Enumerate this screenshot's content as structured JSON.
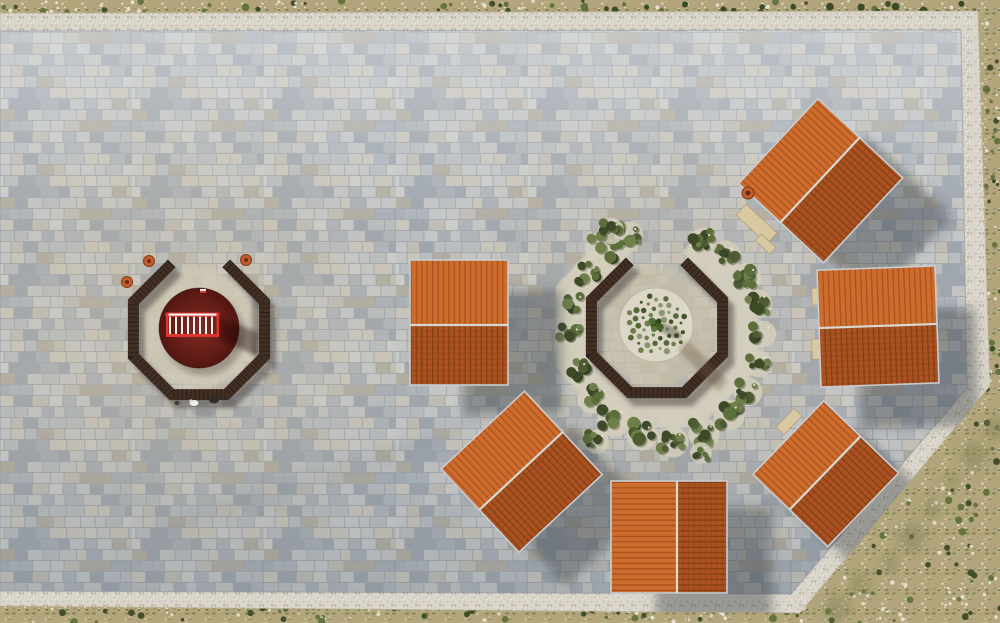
{
  "scene": {
    "width": 1000,
    "height": 623,
    "description": "aerial-drone-view-of-stone-paved-plaza-with-orange-roof-pavilions-and-two-octagonal-seating-gardens"
  },
  "palette": {
    "scrub_base": "#b2a57b",
    "scrub_dark": "#8c835c",
    "shrub_green": "#5c6e3a",
    "shrub_dark": "#3d4a27",
    "rock_white": "#eae6d9",
    "moss": "#85855a",
    "rubble_base": "#d9d5ca",
    "rubble_dot_dark": "#aaa294",
    "rubble_dot_light": "#f3f0e7",
    "rubble_dot_brown": "#b9a88e",
    "paving_gap": "#a2a8ae",
    "tiles": [
      "#c5c7c6",
      "#aeb4ba",
      "#bfbdb5",
      "#a9afb6",
      "#cbccc9",
      "#b9bdc0",
      "#b1ada1",
      "#c2c4c4",
      "#9fa6ae",
      "#c8c5bb"
    ],
    "warm": "#c8b897",
    "roof_light": "#cd6c2c",
    "roof_light_rib": "#9c4a1a",
    "roof_dark": "#ab5220",
    "roof_dark_rib": "#7c3a13",
    "roof_course": "#8a421a",
    "roof_edge": "#c9cdd2",
    "ridge": "#d9d9d4",
    "ring_brown": "#422f23",
    "gravel": "#d5cfbe",
    "gravel_pad": "#d4cebc",
    "gravel_circle": "#dcd6c6",
    "rail_red": "#e03430",
    "rail_white": "#f2f0ec",
    "pot_orange": "#c05f2b",
    "bench_tan": "#d9c9a2",
    "bench_edge": "#b3a07a",
    "shadow": "rgba(62,66,74,0.42)",
    "person_white": "#eeeeea",
    "figure_dark": "#2e2e2a"
  },
  "terrain": {
    "rubble_outer": [
      [
        0,
        13
      ],
      [
        978,
        11
      ],
      [
        990,
        386
      ],
      [
        800,
        613
      ],
      [
        0,
        606
      ]
    ],
    "plaza": [
      [
        0,
        31
      ],
      [
        961,
        30
      ],
      [
        967,
        388
      ],
      [
        791,
        594
      ],
      [
        0,
        591
      ]
    ],
    "diag_a": [
      998,
      392
    ],
    "diag_b": [
      808,
      621
    ],
    "br_region": [
      793,
      384,
      207,
      239
    ]
  },
  "pavilions": [
    {
      "id": "pavilion-1",
      "cx": 820,
      "cy": 180,
      "len": 116,
      "up": 57,
      "down": 59,
      "rot": -47,
      "shadow": [
        50,
        38
      ],
      "chimney": [
        748,
        193
      ],
      "benches": [
        [
          749,
          203,
          15,
          42,
          -47
        ],
        [
          761,
          234,
          9,
          20,
          -47
        ]
      ]
    },
    {
      "id": "pavilion-2",
      "cx": 878,
      "cy": 326,
      "len": 118,
      "up": 58,
      "down": 59,
      "rot": -2,
      "shadow": [
        40,
        42
      ],
      "chimney": null,
      "benches": [
        [
          812,
          288,
          14,
          17,
          -2
        ],
        [
          812,
          339,
          14,
          20,
          -2
        ]
      ]
    },
    {
      "id": "pavilion-3",
      "cx": 825,
      "cy": 473,
      "len": 102,
      "up": 51,
      "down": 53,
      "rot": -46,
      "shadow": [
        34,
        27
      ],
      "chimney": null,
      "benches": [
        [
          776,
          416,
          26,
          11,
          -46
        ]
      ]
    },
    {
      "id": "pavilion-4",
      "cx": 677,
      "cy": 537,
      "len": 112,
      "up": 66,
      "down": 50,
      "rot": -90,
      "shadow": [
        45,
        26
      ],
      "chimney": null,
      "benches": []
    },
    {
      "id": "pavilion-5",
      "cx": 521,
      "cy": 471,
      "len": 114,
      "up": 56,
      "down": 58,
      "rot": -43,
      "shadow": [
        47,
        34
      ],
      "chimney": null,
      "benches": []
    },
    {
      "id": "pavilion-6",
      "cx": 459,
      "cy": 325,
      "len": 98,
      "up": 65,
      "down": 60,
      "rot": 0,
      "shadow": [
        54,
        30
      ],
      "chimney": null,
      "benches": []
    }
  ],
  "octagon_left": {
    "cx": 199,
    "cy": 329,
    "r": 71,
    "ring_w": 11,
    "interior_r": 60,
    "interior_fill": "#d2cab5",
    "red_circle": {
      "cx": 199,
      "cy": 328,
      "r": 40
    },
    "railing": {
      "x": 166,
      "y": 313,
      "w": 53,
      "h": 24
    },
    "marker": [
      203,
      291
    ],
    "pots": [
      [
        149,
        261
      ],
      [
        246,
        260
      ],
      [
        127,
        282
      ]
    ],
    "figures": {
      "person": [
        194,
        403
      ],
      "dark": [
        214,
        400
      ],
      "small": [
        177,
        403
      ]
    }
  },
  "octagon_right": {
    "cx": 657,
    "cy": 327,
    "r": 71,
    "ring_w": 11,
    "interior_r": 60,
    "interior_fill": "#c9c1ab",
    "gravel_circle": {
      "cx": 656,
      "cy": 325,
      "r": 37
    },
    "gravel_ring": {
      "r": 93,
      "w": 30
    },
    "tree": {
      "cx": 656,
      "cy": 325
    },
    "inner_dots": {
      "count": 48,
      "scale": 4.3,
      "dot_min": 1.4,
      "dot_max": 3.2
    }
  },
  "greenery_clusters": [
    [
      602,
      248,
      15
    ],
    [
      586,
      274,
      13
    ],
    [
      573,
      303,
      12
    ],
    [
      569,
      336,
      13
    ],
    [
      577,
      370,
      12
    ],
    [
      592,
      397,
      13
    ],
    [
      613,
      419,
      14
    ],
    [
      641,
      434,
      13
    ],
    [
      672,
      441,
      13
    ],
    [
      703,
      433,
      13
    ],
    [
      728,
      414,
      13
    ],
    [
      747,
      391,
      12
    ],
    [
      758,
      363,
      11
    ],
    [
      762,
      333,
      11
    ],
    [
      757,
      303,
      12
    ],
    [
      746,
      276,
      12
    ],
    [
      724,
      255,
      13
    ],
    [
      702,
      241,
      12
    ],
    [
      628,
      235,
      12
    ],
    [
      610,
      230,
      11
    ],
    [
      596,
      441,
      10
    ],
    [
      700,
      452,
      9
    ]
  ]
}
